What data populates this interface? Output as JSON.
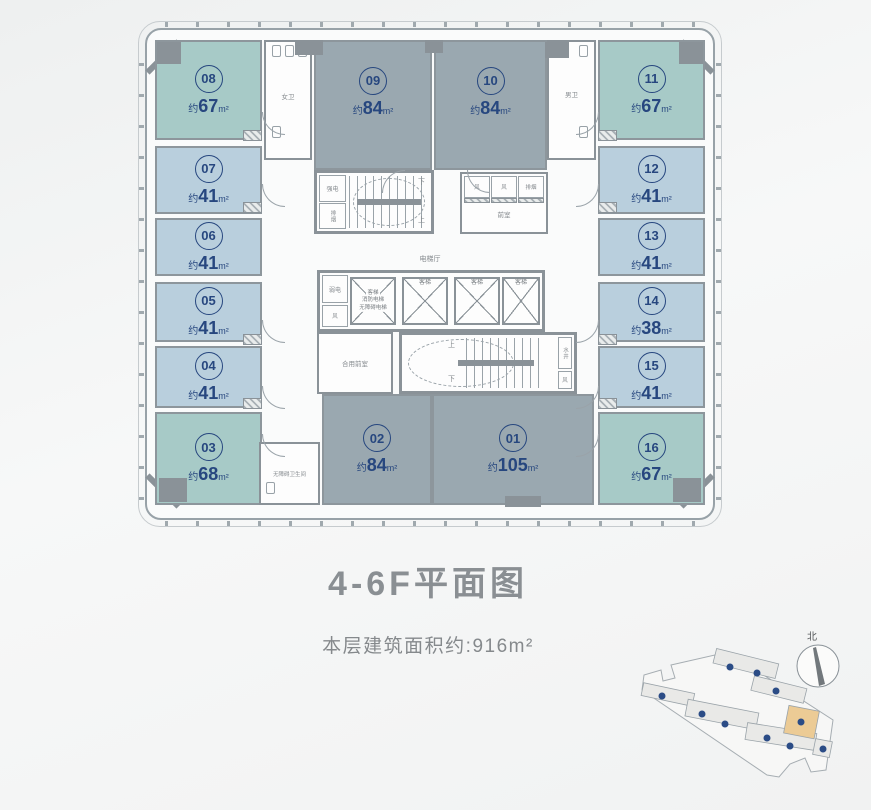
{
  "title": "4-6F平面图",
  "subtitle": "本层建筑面积约:916m²",
  "labels": {
    "area_prefix": "约",
    "area_unit": "m²"
  },
  "units": [
    {
      "num": "01",
      "area": "105"
    },
    {
      "num": "02",
      "area": "84"
    },
    {
      "num": "03",
      "area": "68"
    },
    {
      "num": "04",
      "area": "41"
    },
    {
      "num": "05",
      "area": "41"
    },
    {
      "num": "06",
      "area": "41"
    },
    {
      "num": "07",
      "area": "41"
    },
    {
      "num": "08",
      "area": "67"
    },
    {
      "num": "09",
      "area": "84"
    },
    {
      "num": "10",
      "area": "84"
    },
    {
      "num": "11",
      "area": "67"
    },
    {
      "num": "12",
      "area": "41"
    },
    {
      "num": "13",
      "area": "41"
    },
    {
      "num": "14",
      "area": "38"
    },
    {
      "num": "15",
      "area": "41"
    },
    {
      "num": "16",
      "area": "67"
    }
  ],
  "core": {
    "womens_wc": "女卫",
    "mens_wc": "男卫",
    "accessible_wc": "无障碍卫生间",
    "strong_electric": "强电",
    "weak_electric": "弱电",
    "smoke_exhaust": "排烟",
    "vent": "风",
    "anteroom": "前室",
    "shared_anteroom": "合用前室",
    "elevator_hall": "电梯厅",
    "passenger_elevator": "客梯",
    "combined_elevator_lines": [
      "客梯",
      "消防电梯",
      "无障碍电梯"
    ],
    "water_shaft": "水井",
    "up": "上",
    "down": "下"
  },
  "site_plan": {
    "north_label": "北"
  },
  "colors": {
    "unit_teal": "#a7cac7",
    "unit_blue": "#b9cfdd",
    "unit_gray": "#9aa8b0",
    "wall": "#8a9298",
    "accent_text": "#27477f",
    "highlight_building": "#eccb95",
    "building_dot": "#2b4c86"
  }
}
